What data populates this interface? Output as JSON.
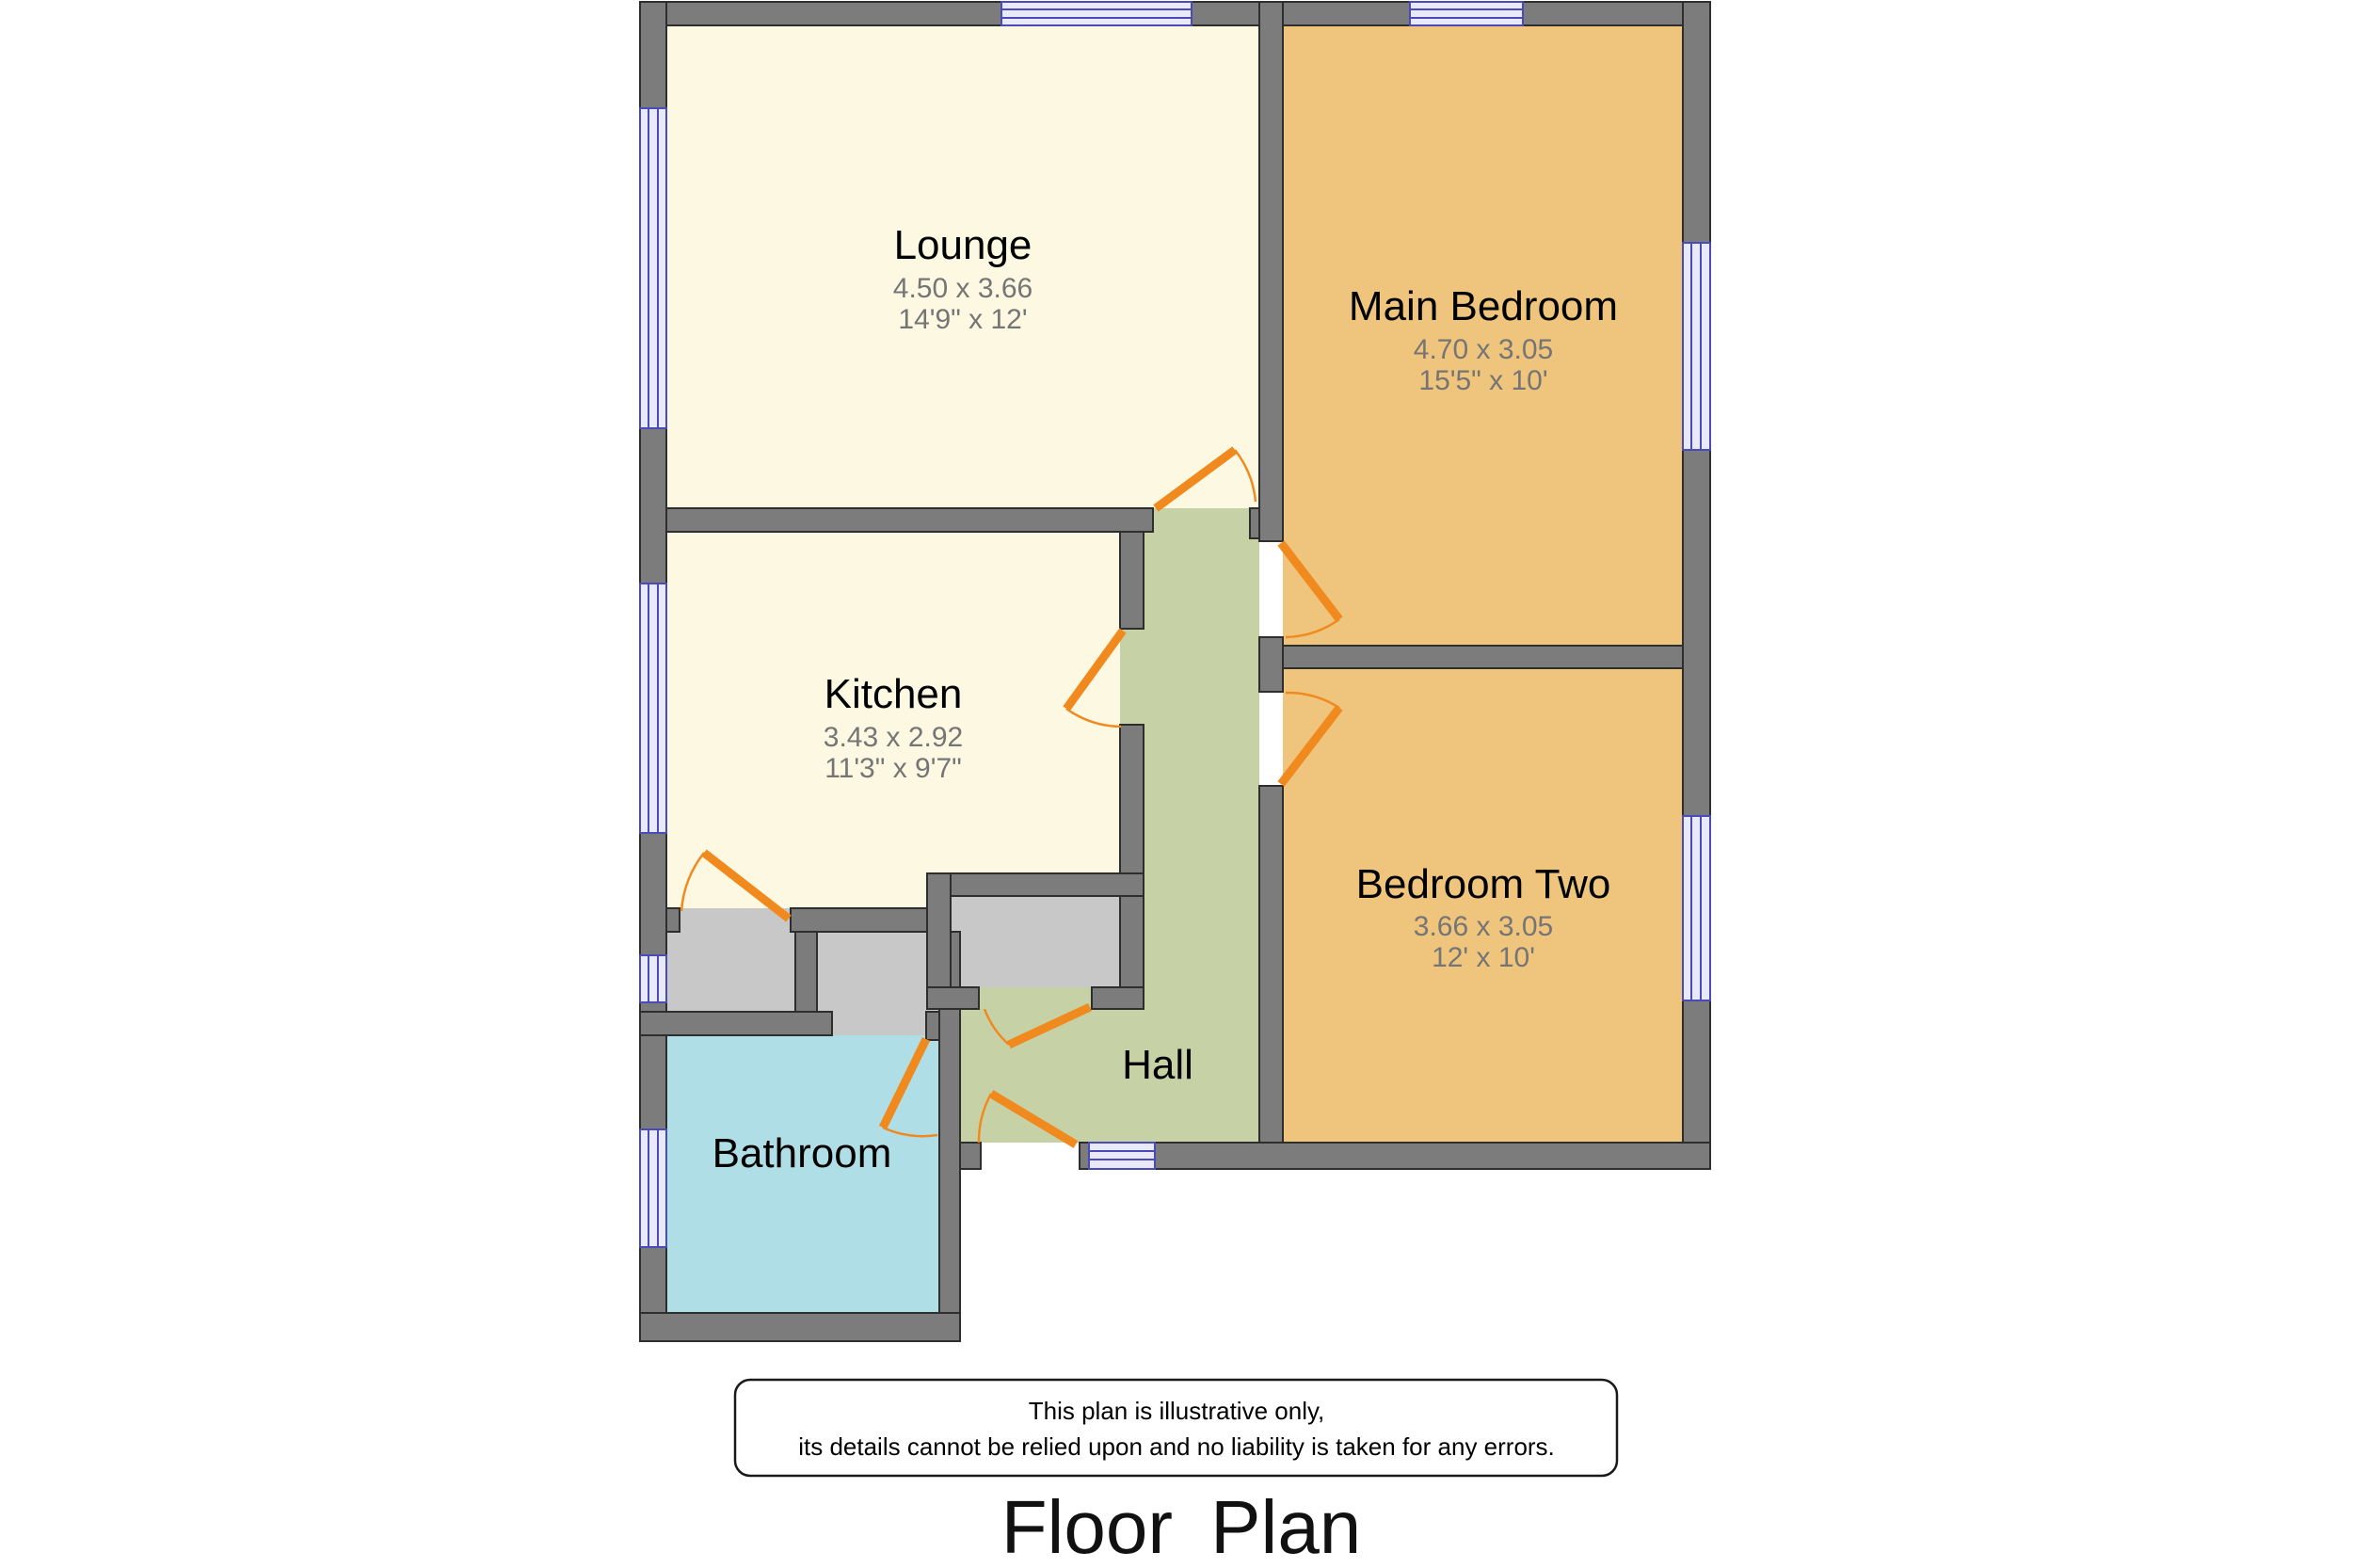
{
  "title": "Floor Plan",
  "disclaimer": {
    "line1": "This plan is illustrative only,",
    "line2": "its details cannot be relied upon and no liability is taken for any errors."
  },
  "rooms": {
    "lounge": {
      "name": "Lounge",
      "dims_metric": "4.50 x 3.66",
      "dims_imperial": "14'9\" x 12'",
      "color": "#FCF8E2"
    },
    "main_bedroom": {
      "name": "Main Bedroom",
      "dims_metric": "4.70 x 3.05",
      "dims_imperial": "15'5\" x 10'",
      "color": "#EFC47D"
    },
    "kitchen": {
      "name": "Kitchen",
      "dims_metric": "3.43 x 2.92",
      "dims_imperial": "11'3\" x 9'7\"",
      "color": "#FCF8E2"
    },
    "bedroom_two": {
      "name": "Bedroom Two",
      "dims_metric": "3.66 x 3.05",
      "dims_imperial": "12' x 10'",
      "color": "#EFC47D"
    },
    "hall": {
      "name": "Hall",
      "color": "#C6D2A6"
    },
    "bathroom": {
      "name": "Bathroom",
      "color": "#AFDEE6"
    }
  },
  "colors": {
    "wall": "#7C7C7C",
    "wall_outline": "#2E2E2E",
    "cupboard_gray": "#C8C8C8",
    "door_orange": "#F08A1E",
    "window_fill": "#E9E9FC",
    "window_line": "#4A4AB8",
    "box_outline": "#1A1A1A",
    "background": "#FFFFFF"
  }
}
